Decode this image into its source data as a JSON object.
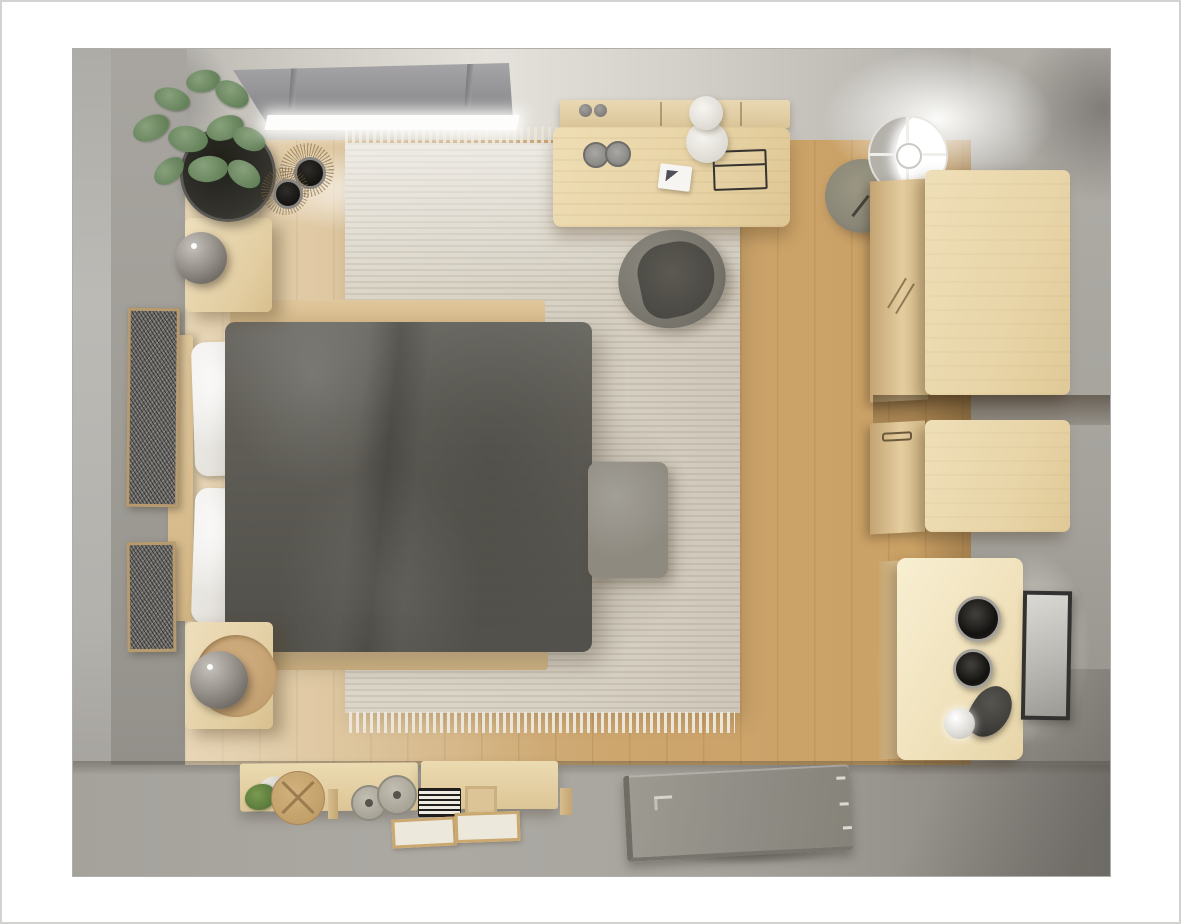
{
  "scene": {
    "type": "3d-top-down-room-render",
    "room": "bedroom floor plan visualization",
    "view": "orthographic top-down cutaway",
    "objects": [
      {
        "name": "window-blind-canopy",
        "area": "top wall",
        "note": "gray roller blind over bright window light"
      },
      {
        "name": "potted-plant",
        "area": "top-left corner"
      },
      {
        "name": "decorative-bowls-on-rattan-mats",
        "count": 2,
        "area": "top-left floor"
      },
      {
        "name": "nightstand-upper",
        "with": "sphere-table-lamp"
      },
      {
        "name": "nightstand-lower",
        "with": "sphere-table-lamp"
      },
      {
        "name": "double-bed",
        "parts": [
          "wood headboard",
          "white pillows",
          "dark gray duvet",
          "wood deck rails"
        ]
      },
      {
        "name": "foot-bench-ottoman",
        "color": "warm gray"
      },
      {
        "name": "area-rug",
        "style": "striped beige with fringe"
      },
      {
        "name": "wall-art-frames-left",
        "count": 2
      },
      {
        "name": "desk",
        "items": [
          "two gray cups",
          "white notepad",
          "wire basket",
          "stacked white lamp"
        ]
      },
      {
        "name": "wall-shelf-above-desk",
        "items": [
          "two knobs"
        ]
      },
      {
        "name": "desk-chair",
        "color": "gray shell"
      },
      {
        "name": "floor-lamp",
        "style": "round shade, lit"
      },
      {
        "name": "round-side-table",
        "color": "olive gray"
      },
      {
        "name": "wardrobe-cabinet-upper",
        "material": "light wood"
      },
      {
        "name": "wardrobe-cabinet-lower",
        "material": "light wood"
      },
      {
        "name": "vanity-desk",
        "items": [
          "two dark jars",
          "black desk lamp with white globe"
        ],
        "lit": true
      },
      {
        "name": "wall-art-frame-right",
        "count": 1
      },
      {
        "name": "console-shelf-bottom",
        "items": [
          "green plant glass",
          "round box with X",
          "glass jars",
          "striped box",
          "wood board",
          "two trays",
          "peg"
        ]
      },
      {
        "name": "entry-door-open-flat",
        "details": [
          "L handle",
          "three hinges"
        ]
      },
      {
        "name": "wood-plank-floor"
      },
      {
        "name": "gray-surround-floor-and-walls"
      }
    ]
  },
  "palette": {
    "c-margin": "#ffffff",
    "c-page-border": "#d2d2d0",
    "c-outer": "#a8a5a0",
    "c-wood": "#cda86f",
    "c-wood-light": "#dcc99f",
    "c-rug": "#d8d2c5",
    "c-rug-fringe": "#ece6da",
    "c-duvet": "#605e57",
    "c-pillow": "#f1efeb",
    "c-bed-wood": "#d9c094",
    "c-stand-wood": "#e8d6b0",
    "c-sphere-lamp": "#938e87",
    "c-green1": "#87a17b",
    "c-green2": "#64815a",
    "c-pot": "#2c2b27",
    "c-frame-wood": "#b79b6f",
    "c-frame-dark": "#343230",
    "c-desk-wood": "#ecd9af",
    "c-chair-shell": "#7e7b73",
    "c-chair-seat": "#53514b",
    "c-canopy": "#929193",
    "c-glow": "#ffffff",
    "c-side-table": "#8b8778",
    "c-wardrobe": "#e8d5a8",
    "c-vanity": "#f2e7c8",
    "c-jar-dark": "#131210",
    "c-door": "#8f8c85",
    "c-ottoman": "#8e8a80",
    "c-console-wood": "#e2cfa3"
  }
}
